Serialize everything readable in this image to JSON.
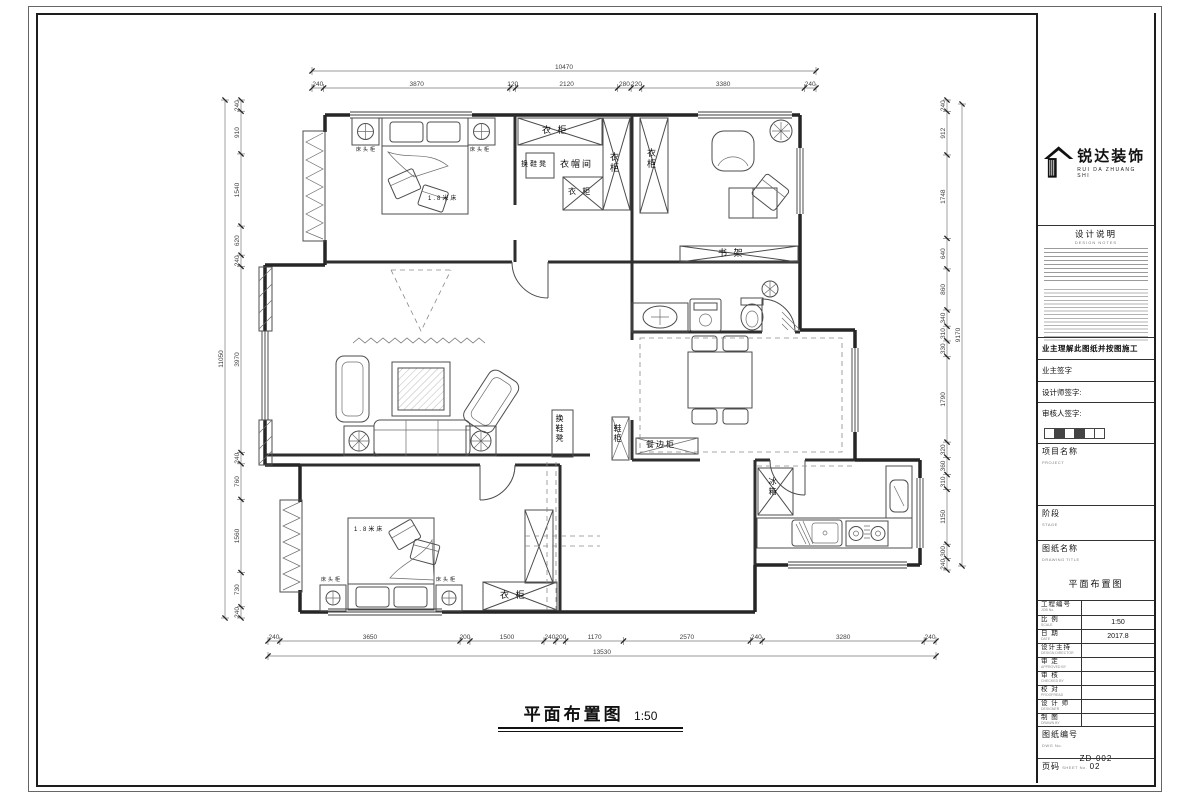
{
  "sheet": {
    "plan_title": "平面布置图",
    "plan_scale": "1:50"
  },
  "title_block": {
    "logo": {
      "company_zh": "锐达装饰",
      "company_en": "RUI DA ZHUANG SHI"
    },
    "design_notes": {
      "heading_zh": "设计说明",
      "heading_en": "DESIGN NOTES"
    },
    "owner_statement": "业主理解此图纸并按图施工",
    "signatures": [
      {
        "label": "业主签字"
      },
      {
        "label": "设计师签字:"
      },
      {
        "label": "审核人签字:"
      }
    ],
    "sections": [
      {
        "label_zh": "项目名称",
        "label_en": "PROJECT",
        "value": ""
      },
      {
        "label_zh": "阶段",
        "label_en": "STAGE",
        "value": ""
      },
      {
        "label_zh": "图纸名称",
        "label_en": "DRAWING TITLE",
        "value": "平面布置图"
      }
    ],
    "rows": [
      {
        "id": "job-no",
        "label_zh": "工程编号",
        "label_en": "JOB No.",
        "value": ""
      },
      {
        "id": "scale",
        "label_zh": "比 例",
        "label_en": "SCALE",
        "value": "1:50"
      },
      {
        "id": "date",
        "label_zh": "日 期",
        "label_en": "DATE",
        "value": "2017.8"
      },
      {
        "id": "design-director",
        "label_zh": "设计主持",
        "label_en": "DESIGN DIRECTOR",
        "value": ""
      },
      {
        "id": "approved",
        "label_zh": "审 定",
        "label_en": "APPROVED BY",
        "value": ""
      },
      {
        "id": "checked",
        "label_zh": "审 核",
        "label_en": "CHECKED BY",
        "value": ""
      },
      {
        "id": "proofread",
        "label_zh": "校 对",
        "label_en": "PROOFREAD",
        "value": ""
      },
      {
        "id": "designer",
        "label_zh": "设 计 师",
        "label_en": "DESIGNER",
        "value": ""
      },
      {
        "id": "drawn",
        "label_zh": "制 图",
        "label_en": "DRAWN BY",
        "value": ""
      }
    ],
    "dwg_no": {
      "label_zh": "图纸编号",
      "label_en": "DWG No.",
      "value": "ZD-002"
    },
    "sheet_no": {
      "label_zh": "页码",
      "label_en": "SHEET No.",
      "value": "02"
    }
  },
  "plan": {
    "labels": [
      {
        "id": "nightstand-1",
        "text": "床头柜",
        "x": 356,
        "y": 148,
        "s": 5
      },
      {
        "id": "nightstand-2",
        "text": "床头柜",
        "x": 470,
        "y": 148,
        "s": 5
      },
      {
        "id": "bed-1",
        "text": "1.8米床",
        "x": 428,
        "y": 196,
        "s": 6
      },
      {
        "id": "wardrobe-top",
        "text": "衣 柜",
        "x": 542,
        "y": 126,
        "s": 9
      },
      {
        "id": "shoe-stool-1",
        "text": "换鞋凳",
        "x": 521,
        "y": 161,
        "s": 7
      },
      {
        "id": "cloakroom",
        "text": "衣帽间",
        "x": 560,
        "y": 160,
        "s": 9
      },
      {
        "id": "wardrobe-right",
        "text": "衣柜",
        "x": 609,
        "y": 152,
        "s": 9,
        "v": 1
      },
      {
        "id": "wardrobe-low",
        "text": "衣 柜",
        "x": 568,
        "y": 188,
        "s": 8
      },
      {
        "id": "wardrobe-study",
        "text": "衣柜",
        "x": 646,
        "y": 148,
        "s": 9,
        "v": 1
      },
      {
        "id": "bookshelf",
        "text": "书 架",
        "x": 718,
        "y": 249,
        "s": 9
      },
      {
        "id": "shoe-stool-2",
        "text": "换鞋凳",
        "x": 555,
        "y": 414,
        "s": 8,
        "v": 1
      },
      {
        "id": "shoe-cabinet",
        "text": "鞋柜",
        "x": 613,
        "y": 424,
        "s": 8,
        "v": 1
      },
      {
        "id": "sideboard",
        "text": "餐边柜",
        "x": 646,
        "y": 441,
        "s": 8
      },
      {
        "id": "fridge",
        "text": "冰箱",
        "x": 768,
        "y": 477,
        "s": 8,
        "v": 1
      },
      {
        "id": "bed-2",
        "text": "1.8米床",
        "x": 354,
        "y": 527,
        "s": 6
      },
      {
        "id": "nightstand-3",
        "text": "床头柜",
        "x": 321,
        "y": 578,
        "s": 5
      },
      {
        "id": "nightstand-4",
        "text": "床头柜",
        "x": 436,
        "y": 578,
        "s": 5
      },
      {
        "id": "wardrobe-bed2",
        "text": "衣 柜",
        "x": 500,
        "y": 591,
        "s": 9
      }
    ],
    "dimensions": {
      "top": {
        "segments": [
          240,
          3870,
          120,
          2120,
          280,
          220,
          3380,
          240
        ],
        "total": 10470
      },
      "bottom": {
        "segments": [
          240,
          3650,
          200,
          1500,
          240,
          200,
          1170,
          2570,
          240,
          3280,
          240
        ],
        "total": 13530
      },
      "left": {
        "segments": [
          240,
          910,
          1540,
          620,
          240,
          3970,
          240,
          760,
          1560,
          730,
          240
        ],
        "total": 11050
      },
      "right": {
        "segments": [
          240,
          912,
          1748,
          640,
          860,
          340,
          310,
          330,
          1790,
          320,
          360,
          310,
          1150,
          300,
          240
        ],
        "total": 9170
      }
    }
  }
}
